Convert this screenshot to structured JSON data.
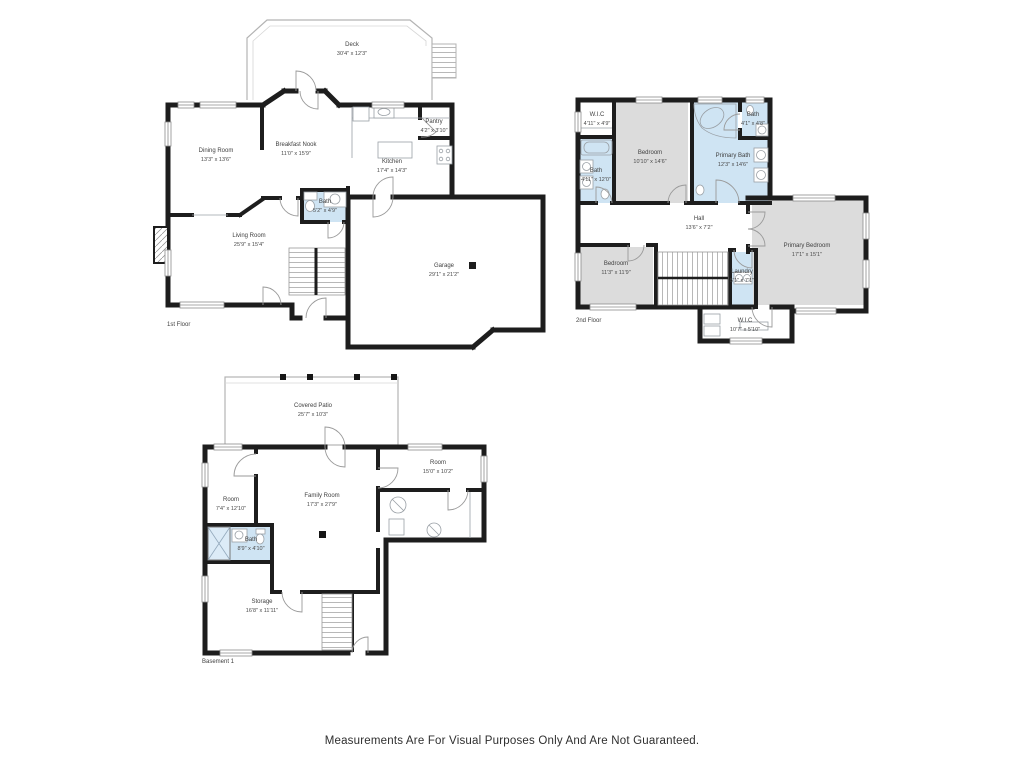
{
  "disclaimer": "Measurements Are For Visual Purposes Only And Are Not Guaranteed.",
  "colors": {
    "wall": "#1d1d1d",
    "bath_fill": "#cfe4f3",
    "bedroom_fill": "#dcdcdc",
    "thin_line": "#9aa0a6",
    "deck_line": "#b3b3b3",
    "text": "#3f3f3f"
  },
  "floors": [
    {
      "label": "1st Floor",
      "rooms": [
        {
          "name": "Deck",
          "dims": "30'4\" x 12'3\""
        },
        {
          "name": "Dining Room",
          "dims": "13'3\" x 13'6\""
        },
        {
          "name": "Breakfast Nook",
          "dims": "11'0\" x 15'9\""
        },
        {
          "name": "Pantry",
          "dims": "4'2\" x 3'10\""
        },
        {
          "name": "Kitchen",
          "dims": "17'4\" x 14'3\""
        },
        {
          "name": "Bath",
          "dims": "5'2\" x 4'9\""
        },
        {
          "name": "Living Room",
          "dims": "25'9\" x 15'4\""
        },
        {
          "name": "Garage",
          "dims": "29'1\" x 21'2\""
        }
      ]
    },
    {
      "label": "2nd Floor",
      "rooms": [
        {
          "name": "W.I.C",
          "dims": "4'11\" x 4'9\""
        },
        {
          "name": "Bedroom",
          "dims": "10'10\" x 14'6\""
        },
        {
          "name": "Bath",
          "dims": "4'1\" x 4'8\""
        },
        {
          "name": "Primary Bath",
          "dims": "12'3\" x 14'6\""
        },
        {
          "name": "Bath",
          "dims": "4'11\" x 12'0\""
        },
        {
          "name": "Hall",
          "dims": "13'6\" x 7'2\""
        },
        {
          "name": "Bedroom",
          "dims": "11'3\" x 11'9\""
        },
        {
          "name": "Laundry",
          "dims": "5'1\" x 7'1\""
        },
        {
          "name": "Primary Bedroom",
          "dims": "17'1\" x 15'1\""
        },
        {
          "name": "W.I.C",
          "dims": "10'7\" x 5'10\""
        }
      ]
    },
    {
      "label": "Basement 1",
      "rooms": [
        {
          "name": "Covered Patio",
          "dims": "25'7\" x 10'3\""
        },
        {
          "name": "Room",
          "dims": "15'0\" x 10'2\""
        },
        {
          "name": "Room",
          "dims": "7'4\" x 12'10\""
        },
        {
          "name": "Family Room",
          "dims": "17'3\" x 27'9\""
        },
        {
          "name": "Bath",
          "dims": "8'9\" x 4'10\""
        },
        {
          "name": "Storage",
          "dims": "16'8\" x 11'11\""
        }
      ]
    }
  ]
}
